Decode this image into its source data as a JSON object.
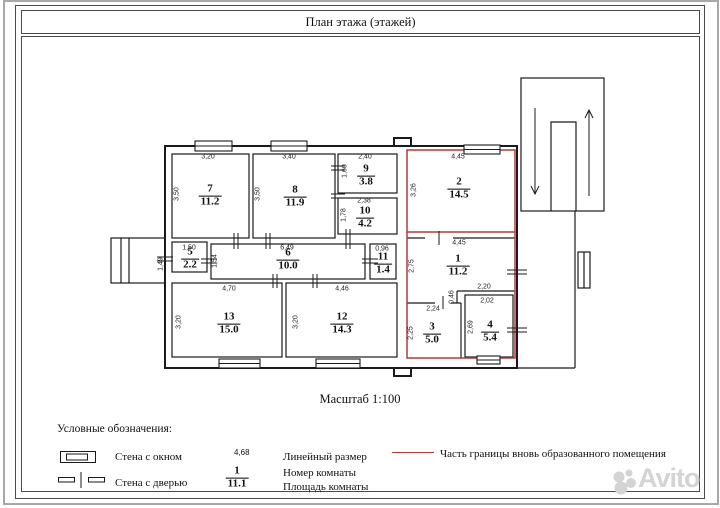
{
  "page": {
    "title": "План этажа (этажей)",
    "scale_label": "Масштаб 1:100",
    "watermark": "Avito"
  },
  "colors": {
    "boundary_red": "#b23b37",
    "line_black": "#1a1a1a",
    "frame_gray": "#a8a8a8"
  },
  "rooms": [
    {
      "number": "1",
      "area": "11.2"
    },
    {
      "number": "2",
      "area": "14.5"
    },
    {
      "number": "3",
      "area": "5.0"
    },
    {
      "number": "4",
      "area": "5.4"
    },
    {
      "number": "5",
      "area": "2.2"
    },
    {
      "number": "6",
      "area": "10.0"
    },
    {
      "number": "7",
      "area": "11.2"
    },
    {
      "number": "8",
      "area": "11.9"
    },
    {
      "number": "9",
      "area": "3.8"
    },
    {
      "number": "10",
      "area": "4.2"
    },
    {
      "number": "11",
      "area": "1.4"
    },
    {
      "number": "12",
      "area": "14.3"
    },
    {
      "number": "13",
      "area": "15.0"
    }
  ],
  "dims": {
    "room1_width": "4,45",
    "room1_height": "2,75",
    "room2_width": "4,45",
    "room2_height": "3,26",
    "room3_width": "2,24",
    "room3_height": "2,25",
    "room4_width": "2,02",
    "room4_height": "2,69",
    "room4_outer_width": "2,20",
    "rooms34_jog": "0,46",
    "room5_width": "1,50",
    "room5_height": "1,49",
    "room6_width": "6,49",
    "room6_height": "1,54",
    "room7_width": "3,20",
    "room7_height": "3,50",
    "room8_width": "3,40",
    "room8_height": "3,50",
    "room9_width": "2,40",
    "room9_height": "1,60",
    "room10_width": "2,38",
    "room10_height": "1,78",
    "room11_width": "0,96",
    "room12_width": "4,46",
    "room12_height": "3,20",
    "room13_width": "4,70",
    "room13_height": "3,20"
  },
  "legend": {
    "heading": "Условные обозначения:",
    "wall_window": "Стена с окном",
    "wall_door": "Стена с дверью",
    "linear_size_example": "4,68",
    "linear_size": "Линейный размер",
    "room_number_example": "1",
    "room_area_example": "11.1",
    "room_number": "Номер комнаты",
    "room_area": "Площадь комнаты",
    "red_boundary": "Часть границы вновь образованного помещения"
  }
}
